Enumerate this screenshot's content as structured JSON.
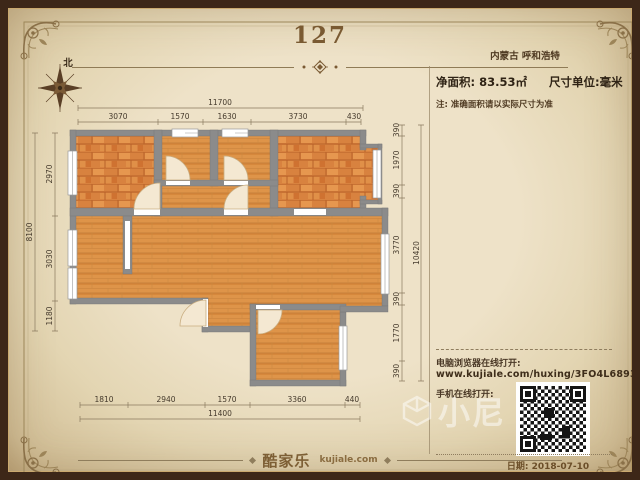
{
  "header": {
    "title": "127",
    "region": "内蒙古 呼和浩特"
  },
  "info": {
    "net_area_label": "净面积:",
    "net_area_value": "83.53㎡",
    "unit_label": "尺寸单位:毫米",
    "note": "注: 准确面积请以实际尺寸为准"
  },
  "compass": {
    "north_label": "北"
  },
  "links": {
    "pc_label": "电脑浏览器在线打开:",
    "url": "www.kujiale.com/huxing/3FO4L6893WU3",
    "mobile_label": "手机在线打开:"
  },
  "footer": {
    "brand": "酷家乐",
    "brand_domain": "kujiale.com",
    "date": "日期: 2018-07-10"
  },
  "watermark": {
    "text": "小尼"
  },
  "plan": {
    "dims_top_total": "11700",
    "dims_top": [
      "3070",
      "1570",
      "1630",
      "3730",
      "430"
    ],
    "dims_left_total": "8100",
    "dims_left": [
      "2970",
      "3030",
      "1180"
    ],
    "dims_right": [
      "390",
      "1970",
      "390",
      "3770",
      "390",
      "1770",
      "390"
    ],
    "dims_right_total": "10420",
    "dims_bottom": [
      "1810",
      "2940",
      "1570",
      "3360",
      "440"
    ],
    "dims_bottom_total": "11400",
    "colors": {
      "wall": "#8b8b8b",
      "bedroom_floor": "#d8823f",
      "room_floor": "#de9449",
      "paper": "#ece0c4",
      "frame_brown": "#8a7048",
      "qr_black": "#151515"
    }
  }
}
